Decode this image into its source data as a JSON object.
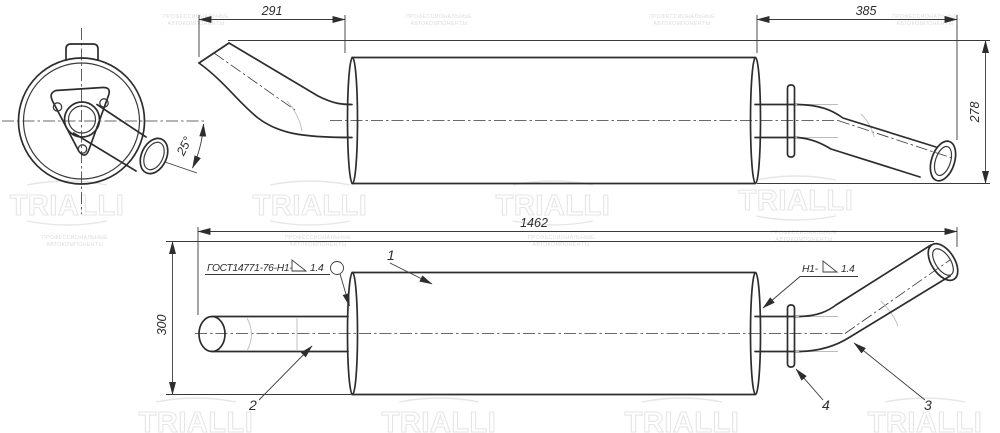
{
  "dimensions": {
    "inlet_length": "291",
    "outlet_length": "385",
    "overall_height": "278",
    "overall_length": "1462",
    "view_height": "300",
    "inlet_angle": "25°"
  },
  "weld_callouts": {
    "left": {
      "standard": "ГОСТ14771-76-Н1-",
      "size": "1.4"
    },
    "right": {
      "prefix": "Н1-",
      "size": "1.4"
    }
  },
  "part_labels": {
    "muffler_body": "1",
    "inlet_pipe": "2",
    "outlet_pipe": "3",
    "bracket": "4"
  },
  "watermark": {
    "logo": "TRIALLI",
    "tagline_line1": "ПРОФЕССИОНАЛЬНЫЕ",
    "tagline_line2": "АВТОКОМПОНЕНТЫ"
  }
}
